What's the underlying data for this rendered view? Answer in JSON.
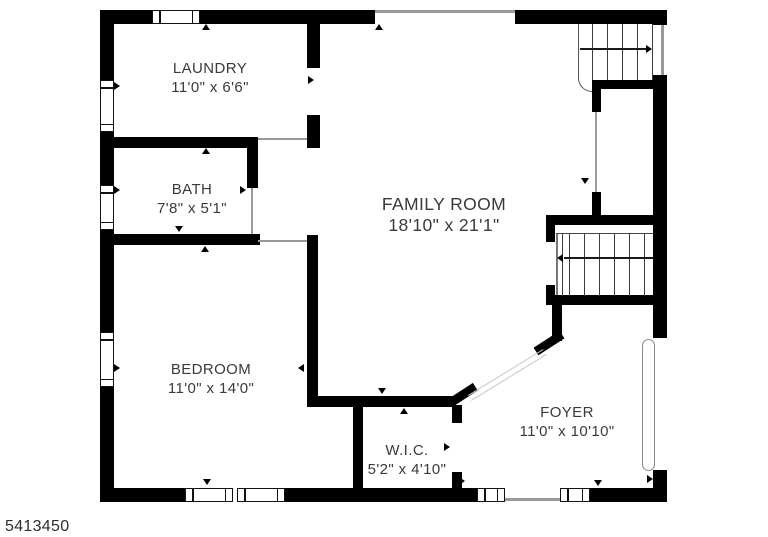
{
  "listing_id": "5413450",
  "rooms": [
    {
      "name": "LAUNDRY",
      "dims": "11'0\" x 6'6\""
    },
    {
      "name": "BATH",
      "dims": "7'8\" x 5'1\""
    },
    {
      "name": "FAMILY ROOM",
      "dims": "18'10\" x 21'1\""
    },
    {
      "name": "BEDROOM",
      "dims": "11'0\" x 14'0\""
    },
    {
      "name": "W.I.C.",
      "dims": "5'2\" x 4'10\""
    },
    {
      "name": "FOYER",
      "dims": "11'0\" x 10'10\""
    }
  ],
  "stairs": [
    {
      "location": "top-right",
      "direction_arrow": "right"
    },
    {
      "location": "mid-right",
      "direction_arrow": "left"
    }
  ],
  "colors": {
    "wall": "#000000",
    "label_text": "#3a3a3a",
    "opening_line": "#9a9a9a"
  }
}
